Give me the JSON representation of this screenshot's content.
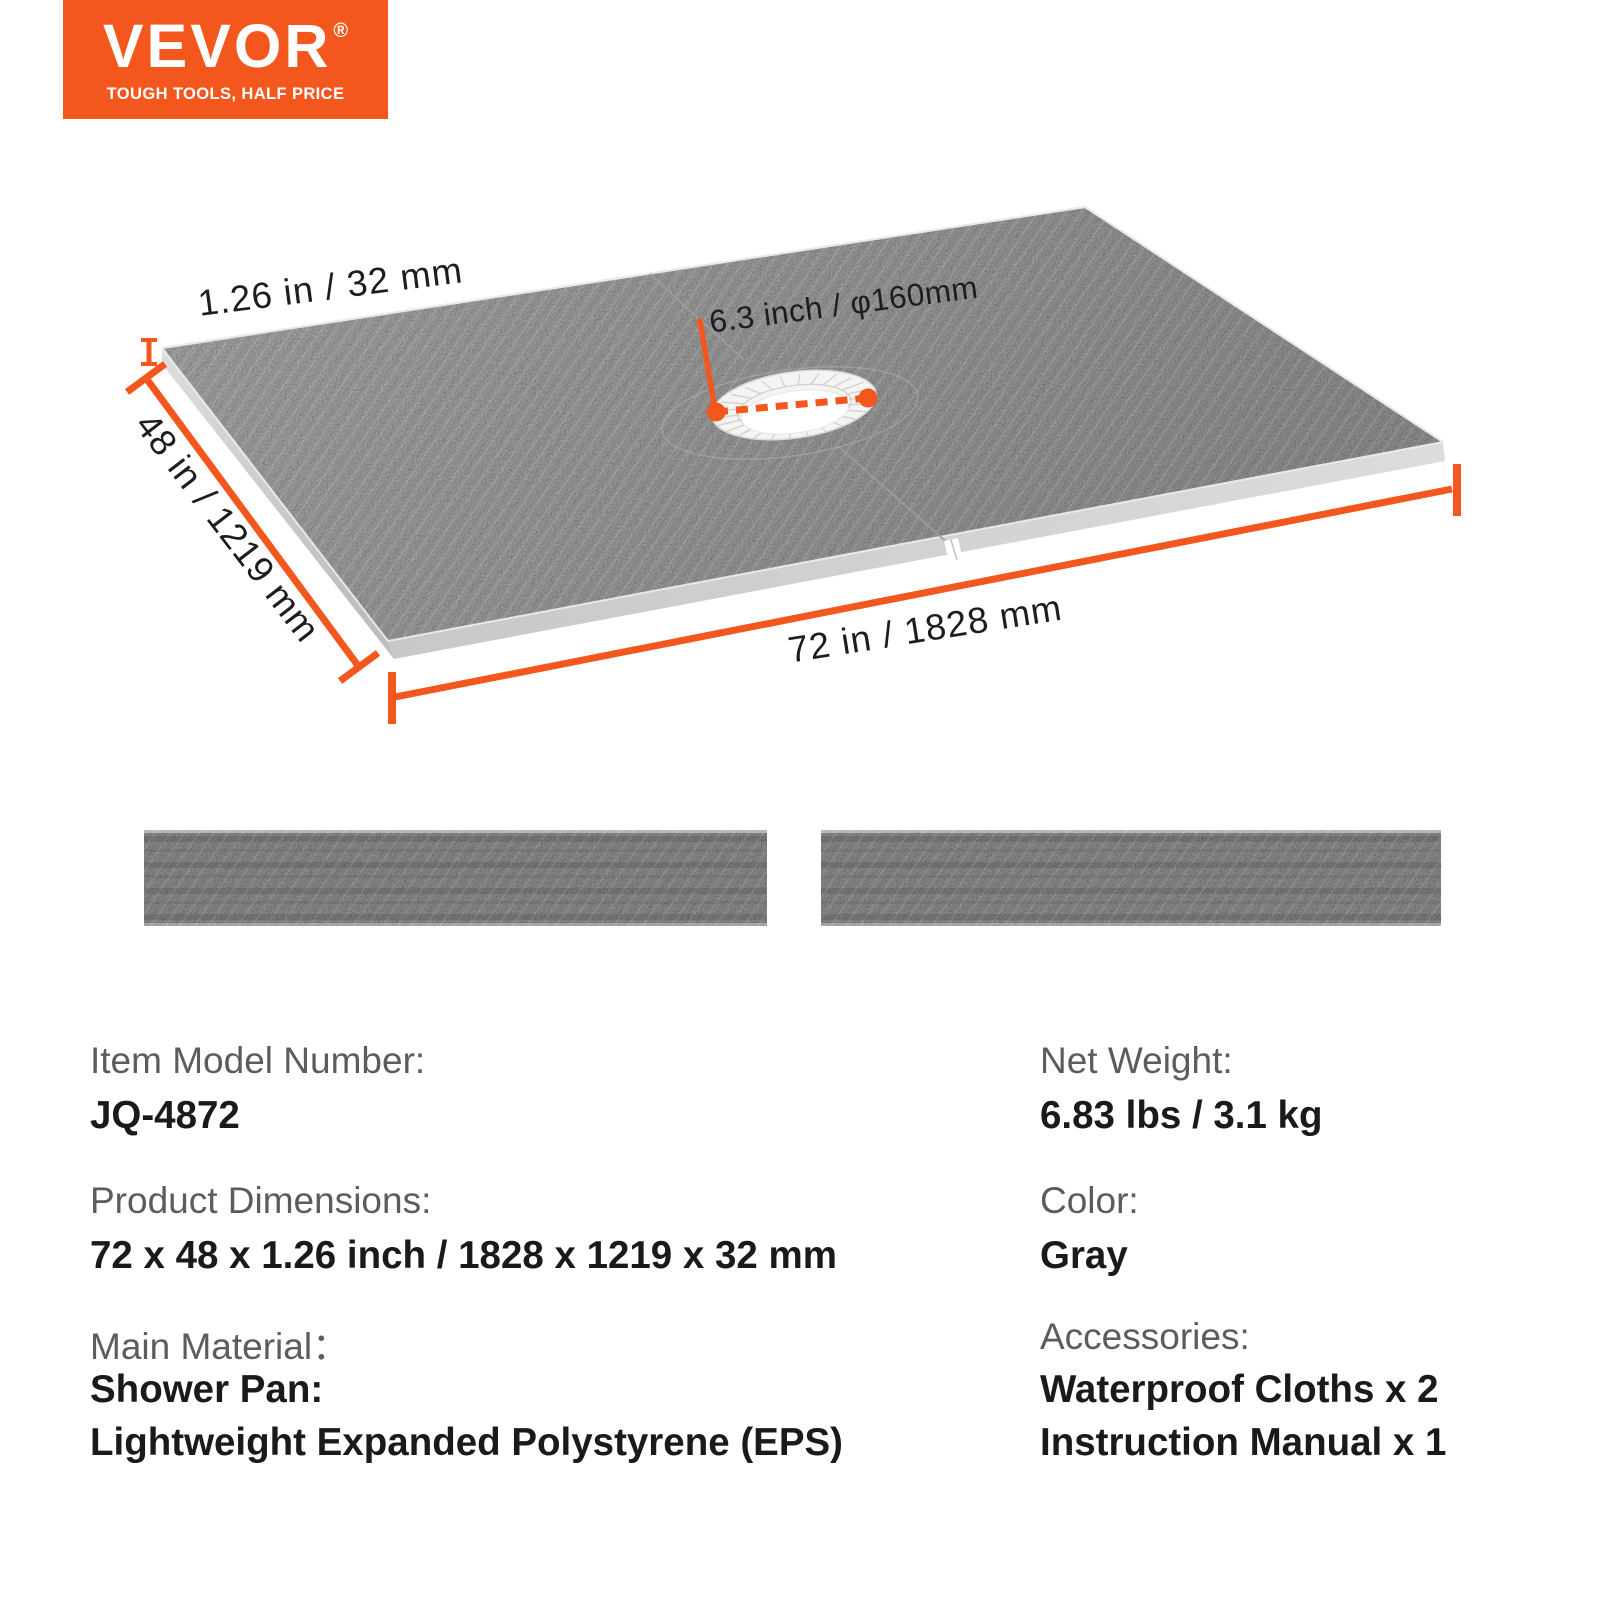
{
  "brand": {
    "logo_text": "VEVOR",
    "registered_mark": "®",
    "tagline": "TOUGH TOOLS, HALF PRICE"
  },
  "diagram": {
    "thickness_label": "1.26 in / 32 mm",
    "width_label": "48 in / 1219 mm",
    "length_label": "72 in / 1828 mm",
    "drain_label": "6.3 inch / φ160mm"
  },
  "specs": {
    "left": [
      {
        "label": "Item Model Number:",
        "values": [
          "JQ-4872"
        ]
      },
      {
        "label": "Product Dimensions:",
        "values": [
          "72 x 48 x 1.26 inch / 1828 x 1219 x 32 mm"
        ]
      },
      {
        "label": "Main Material：",
        "values": [
          "Shower Pan:",
          "Lightweight Expanded Polystyrene (EPS)"
        ]
      }
    ],
    "right": [
      {
        "label": "Net Weight:",
        "values": [
          "6.83 lbs / 3.1 kg"
        ]
      },
      {
        "label": "Color:",
        "values": [
          "Gray"
        ]
      },
      {
        "label": "Accessories:",
        "values": [
          "Waterproof Cloths x 2",
          "Instruction Manual x 1"
        ]
      }
    ]
  },
  "colors": {
    "accent": "#F4571D",
    "label_gray": "#5c5c5c",
    "value_black": "#1a1a1a",
    "pan_gray": "#b5b5b5",
    "strip_gray": "#a5a5a8",
    "drain_white": "#f4f4f2"
  }
}
